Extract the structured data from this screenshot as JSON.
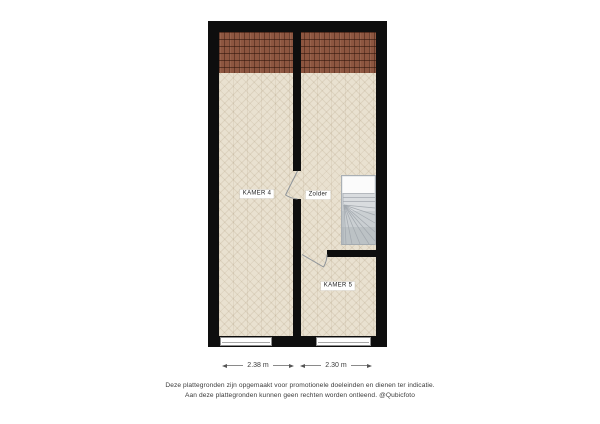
{
  "floorplan": {
    "rooms": [
      {
        "id": "kamer4",
        "label": "KAMER 4"
      },
      {
        "id": "zolder",
        "label": "Zolder"
      },
      {
        "id": "kamer5",
        "label": "KAMER 5"
      }
    ],
    "features": [
      "staircase",
      "roof-hatch",
      "two-windows",
      "two-door-swings"
    ],
    "colors": {
      "wall": "#0e0e0e",
      "floor": "#e9e1d0",
      "roof_tile": "#8d5640",
      "stairs": "#d9dcdf",
      "door_symbol": "#8d9399",
      "dimension_line": "#555555",
      "label_text": "#222222"
    }
  },
  "dimensions": [
    {
      "label": "2.38 m"
    },
    {
      "label": "2.30 m"
    }
  ],
  "footer": {
    "line1": "Deze plattegronden zijn opgemaakt voor promotionele doeleinden en dienen ter indicatie.",
    "line2": "Aan deze plattegronden kunnen geen rechten worden ontleend. @Qubicfoto"
  }
}
